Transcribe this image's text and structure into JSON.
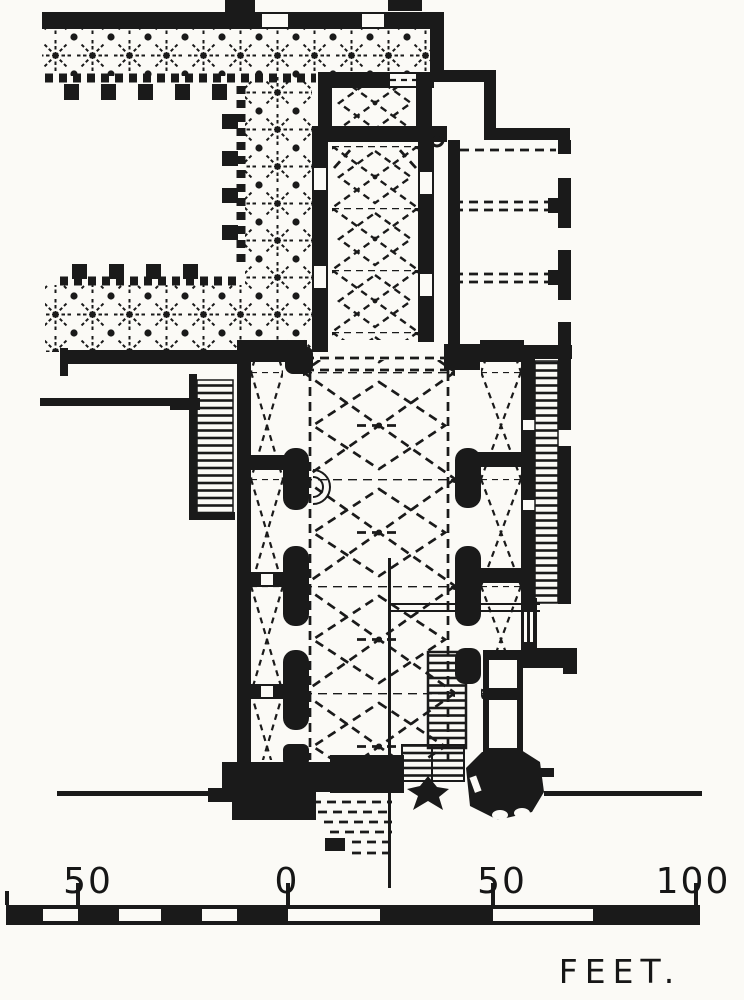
{
  "figure": {
    "kind": "engraved-floor-plan",
    "colors": {
      "ink": "#1a1a1a",
      "paper": "#fbfaf6"
    }
  },
  "scale_bar": {
    "labels": [
      "50",
      "0",
      "50",
      "100"
    ],
    "unit_label": "FEET."
  }
}
